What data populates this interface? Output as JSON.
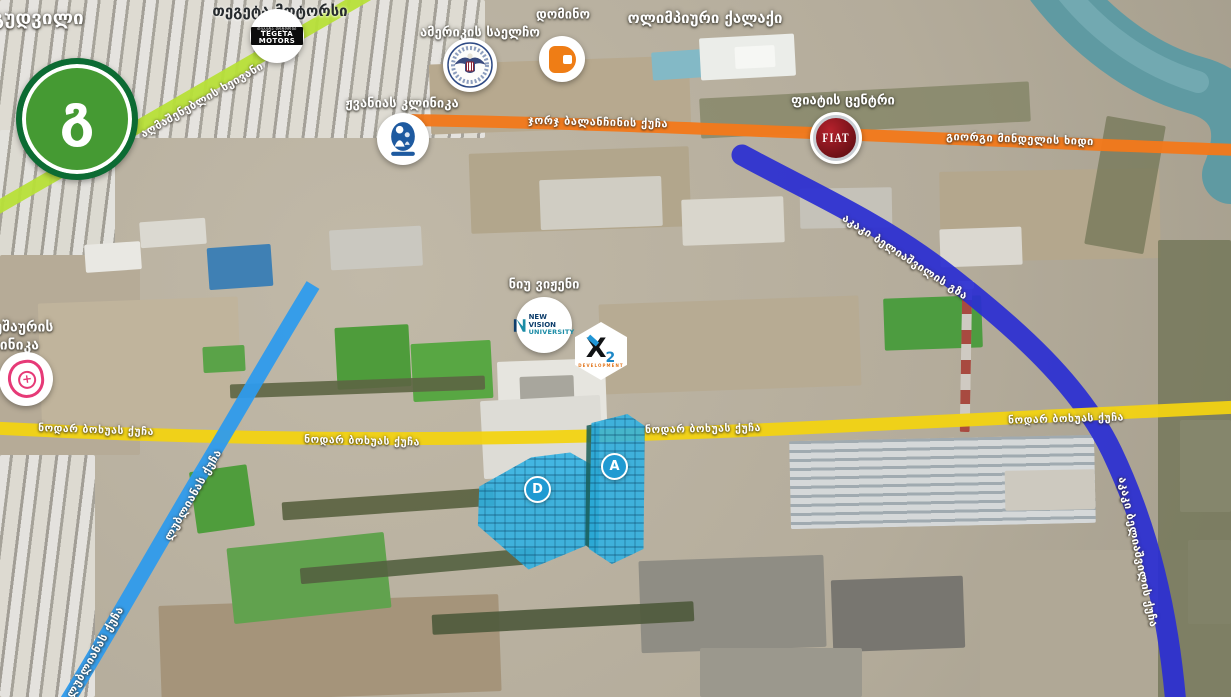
{
  "labels": {
    "goodwill": "გუდვილი",
    "tegeta": "თეგეტა მოტორსი",
    "embassy": "ამერიკის საელჩო",
    "domino": "დომინო",
    "olympic_city": "ოლიმპიური ქალაქი",
    "zhvania_clinic": "ჟვანიას კლინიკა",
    "fiat_center": "ფიატის ცენტრი",
    "ghudushauri_line1": "ღუდუშაურის",
    "ghudushauri_line2": "კლინიკა",
    "new_vision": "ნიუ ვიჟენი"
  },
  "roads": {
    "aghmashenebeli": {
      "label": "აღმაშენებლის ხეივანი",
      "color": "#b7e038"
    },
    "balanchine": {
      "label": "ჯორჯ ბალანჩინის ქუჩა",
      "color": "#f2791b"
    },
    "mindeli_bridge": {
      "label": "გიორგი მინდელის ხიდი",
      "color": "#f2791b"
    },
    "beliashvili": {
      "label_diagonal": "აკაკი ბელიაშვილის გზა",
      "label_vertical": "აკაკი ბელიაშვილის ქუჩა",
      "color": "#2b2ed2"
    },
    "bokhua": {
      "label": "ნოდარ ბოხუას ქუჩა",
      "color": "#f2d312"
    },
    "lubliana": {
      "label": "ლუბლიანას ქუჩა",
      "color": "#2e9bec"
    }
  },
  "badges": {
    "goodwill_glyph": "გ",
    "tegeta_box_line1": "თეგეტა მოტორსი",
    "tegeta_box_line2": "TEGETA MOTORS",
    "fiat_logo": "FIAT",
    "new_vision_line1": "NEW VISION",
    "new_vision_line2": "UNIVERSITY",
    "x2_x": "X",
    "x2_2": "2",
    "x2_sub": "DEVELOPMENT",
    "block_d": "D",
    "block_a": "A"
  },
  "colors": {
    "building_highlight": "#2eb0e2",
    "river": "#5f9aa2",
    "unit_marker": "#1f9ad2"
  }
}
